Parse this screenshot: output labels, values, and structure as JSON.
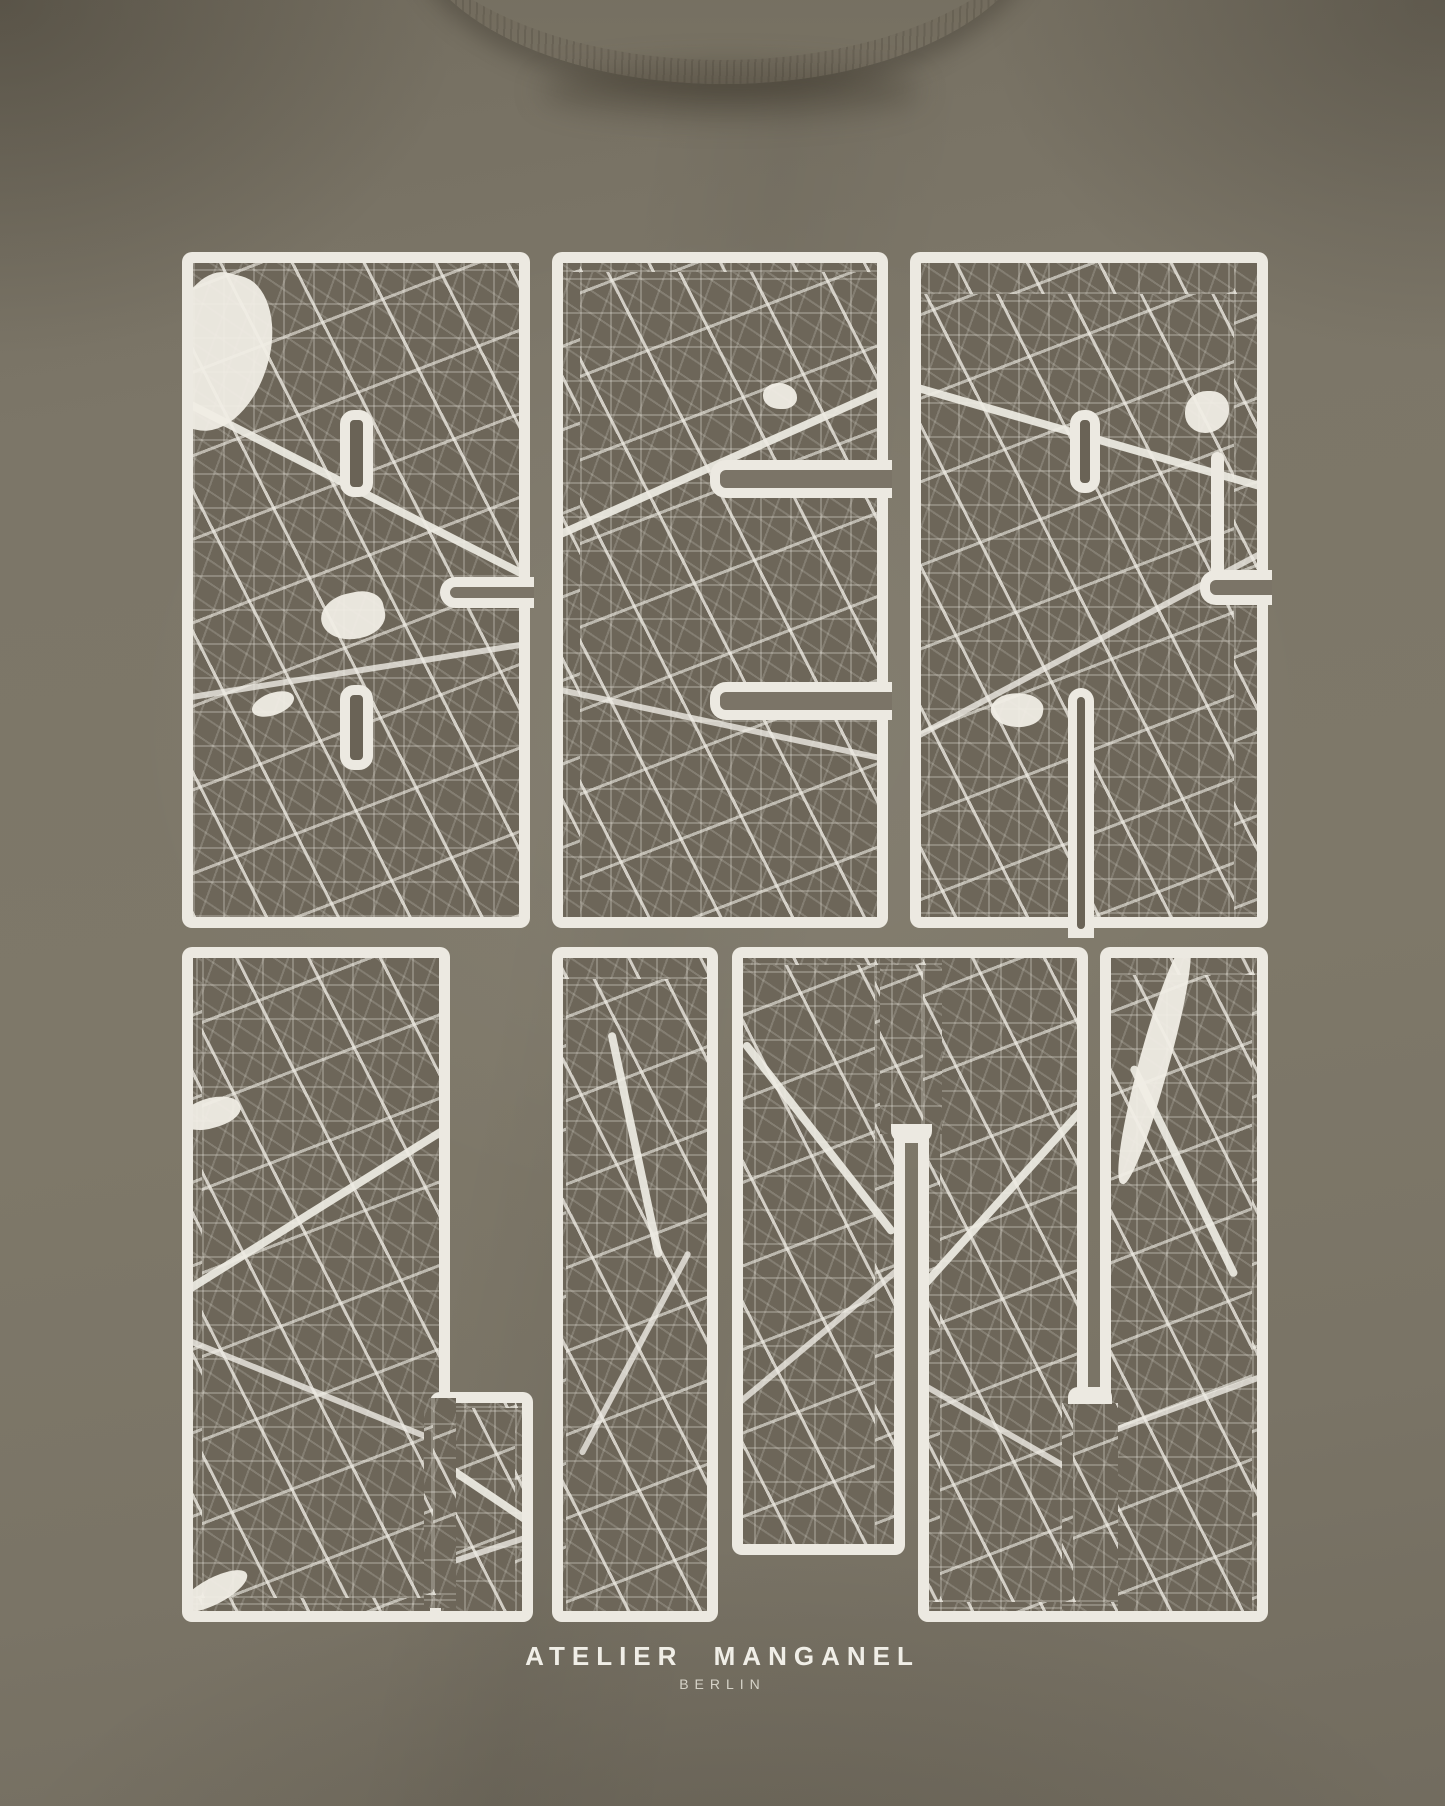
{
  "design": {
    "word": "BERLIN",
    "letters": [
      {
        "char": "B",
        "row": 1
      },
      {
        "char": "E",
        "row": 1
      },
      {
        "char": "R",
        "row": 1
      },
      {
        "char": "L",
        "row": 2
      },
      {
        "char": "I",
        "row": 2
      },
      {
        "char": "N",
        "row": 2
      }
    ]
  },
  "brand": {
    "name": "ATELIER MANGANEL",
    "city": "BERLIN"
  },
  "colors": {
    "fabric": "#7b7567",
    "map_panel": "#6d6659",
    "ink": "#ece9e1",
    "ink_dim": "#d6d3c8",
    "shadow": "#5e584c"
  }
}
